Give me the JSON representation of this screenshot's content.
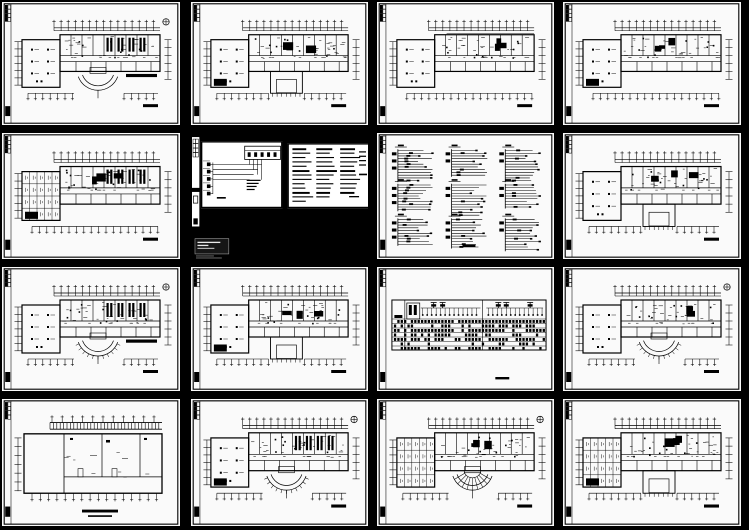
{
  "page": {
    "background": "#000000",
    "description": "grid-of-cad-drawing-sheet-thumbnails"
  },
  "colors": {
    "paper": "#fafafa",
    "ink": "#000000",
    "dark_paper": "#000000",
    "stamp_fill": "#161616",
    "stamp_text": "#e8e8e8",
    "stamp_border": "#9a9a9a",
    "faint": "#666666"
  },
  "grid": {
    "rows": 4,
    "cols": 4,
    "sheet_count": 16
  },
  "sheets": [
    {
      "id": "sheet-r1c1",
      "name": "floor-plan-sheet",
      "type": "floorplan",
      "seed": 101,
      "variant": {
        "arc": true,
        "north": true,
        "left": "open",
        "hatch": true,
        "darkbar": true,
        "scalebar": true
      }
    },
    {
      "id": "sheet-r1c2",
      "name": "floor-plan-sheet",
      "type": "floorplan",
      "seed": 102,
      "variant": {
        "bump": true,
        "blob": true,
        "inkblots": true,
        "left": "open",
        "scalebar": true
      }
    },
    {
      "id": "sheet-r1c3",
      "name": "floor-plan-sheet",
      "type": "floorplan",
      "seed": 103,
      "variant": {
        "inkblots": true,
        "left": "open",
        "denseTop": true,
        "scalebar": true
      }
    },
    {
      "id": "sheet-r1c4",
      "name": "floor-plan-sheet",
      "type": "floorplan",
      "seed": 104,
      "variant": {
        "left": "open",
        "blob": true,
        "inkblots": true,
        "scalebar": true
      }
    },
    {
      "id": "sheet-r2c1",
      "name": "floor-plan-sheet",
      "type": "floorplan",
      "seed": 105,
      "variant": {
        "left": "grid",
        "hatch": true,
        "blob": true,
        "inkblots": true,
        "scalebar": true
      }
    },
    {
      "id": "sheet-r2c2",
      "name": "electrical-system-schematic-sheet",
      "type": "schematic",
      "seed": 106,
      "variant": {}
    },
    {
      "id": "sheet-r2c3",
      "name": "distribution-riser-diagram-sheet",
      "type": "risers",
      "seed": 107,
      "variant": {}
    },
    {
      "id": "sheet-r2c4",
      "name": "floor-plan-sheet",
      "type": "floorplan",
      "seed": 108,
      "variant": {
        "bump": true,
        "inkblots": true,
        "left": "open",
        "scalebar": true
      }
    },
    {
      "id": "sheet-r3c1",
      "name": "floor-plan-sheet",
      "type": "floorplan",
      "seed": 109,
      "variant": {
        "arc": true,
        "arcTicks": true,
        "north": true,
        "left": "open",
        "hatch": true,
        "darkbar": true,
        "scalebar": true
      }
    },
    {
      "id": "sheet-r3c2",
      "name": "floor-plan-sheet",
      "type": "floorplan",
      "seed": 110,
      "variant": {
        "bump": true,
        "blob": true,
        "left": "open",
        "inkblots": true,
        "scalebar": true
      }
    },
    {
      "id": "sheet-r3c3",
      "name": "busway-section-schedule-sheet",
      "type": "band",
      "seed": 111,
      "variant": {}
    },
    {
      "id": "sheet-r3c4",
      "name": "floor-plan-sheet",
      "type": "floorplan",
      "seed": 112,
      "variant": {
        "arc": true,
        "arcTicks": true,
        "north": true,
        "left": "open",
        "inkblots": true,
        "scalebar": true
      }
    },
    {
      "id": "sheet-r4c1",
      "name": "basement-plan-sheet",
      "type": "basement",
      "seed": 113,
      "variant": {}
    },
    {
      "id": "sheet-r4c2",
      "name": "floor-plan-sheet",
      "type": "floorplan",
      "seed": 114,
      "variant": {
        "arc": true,
        "arcTicks": true,
        "north": true,
        "left": "open",
        "hatch": true,
        "blob": true,
        "scalebar": true
      }
    },
    {
      "id": "sheet-r4c3",
      "name": "floor-plan-sheet",
      "type": "floorplan",
      "seed": 115,
      "variant": {
        "arc": true,
        "fan": true,
        "north": true,
        "left": "grid",
        "inkblots": true,
        "scalebar": true
      }
    },
    {
      "id": "sheet-r4c4",
      "name": "floor-plan-sheet",
      "type": "floorplan",
      "seed": 116,
      "variant": {
        "bump": true,
        "left": "grid",
        "blob": true,
        "inkblots": true,
        "scalebar": true
      }
    }
  ]
}
